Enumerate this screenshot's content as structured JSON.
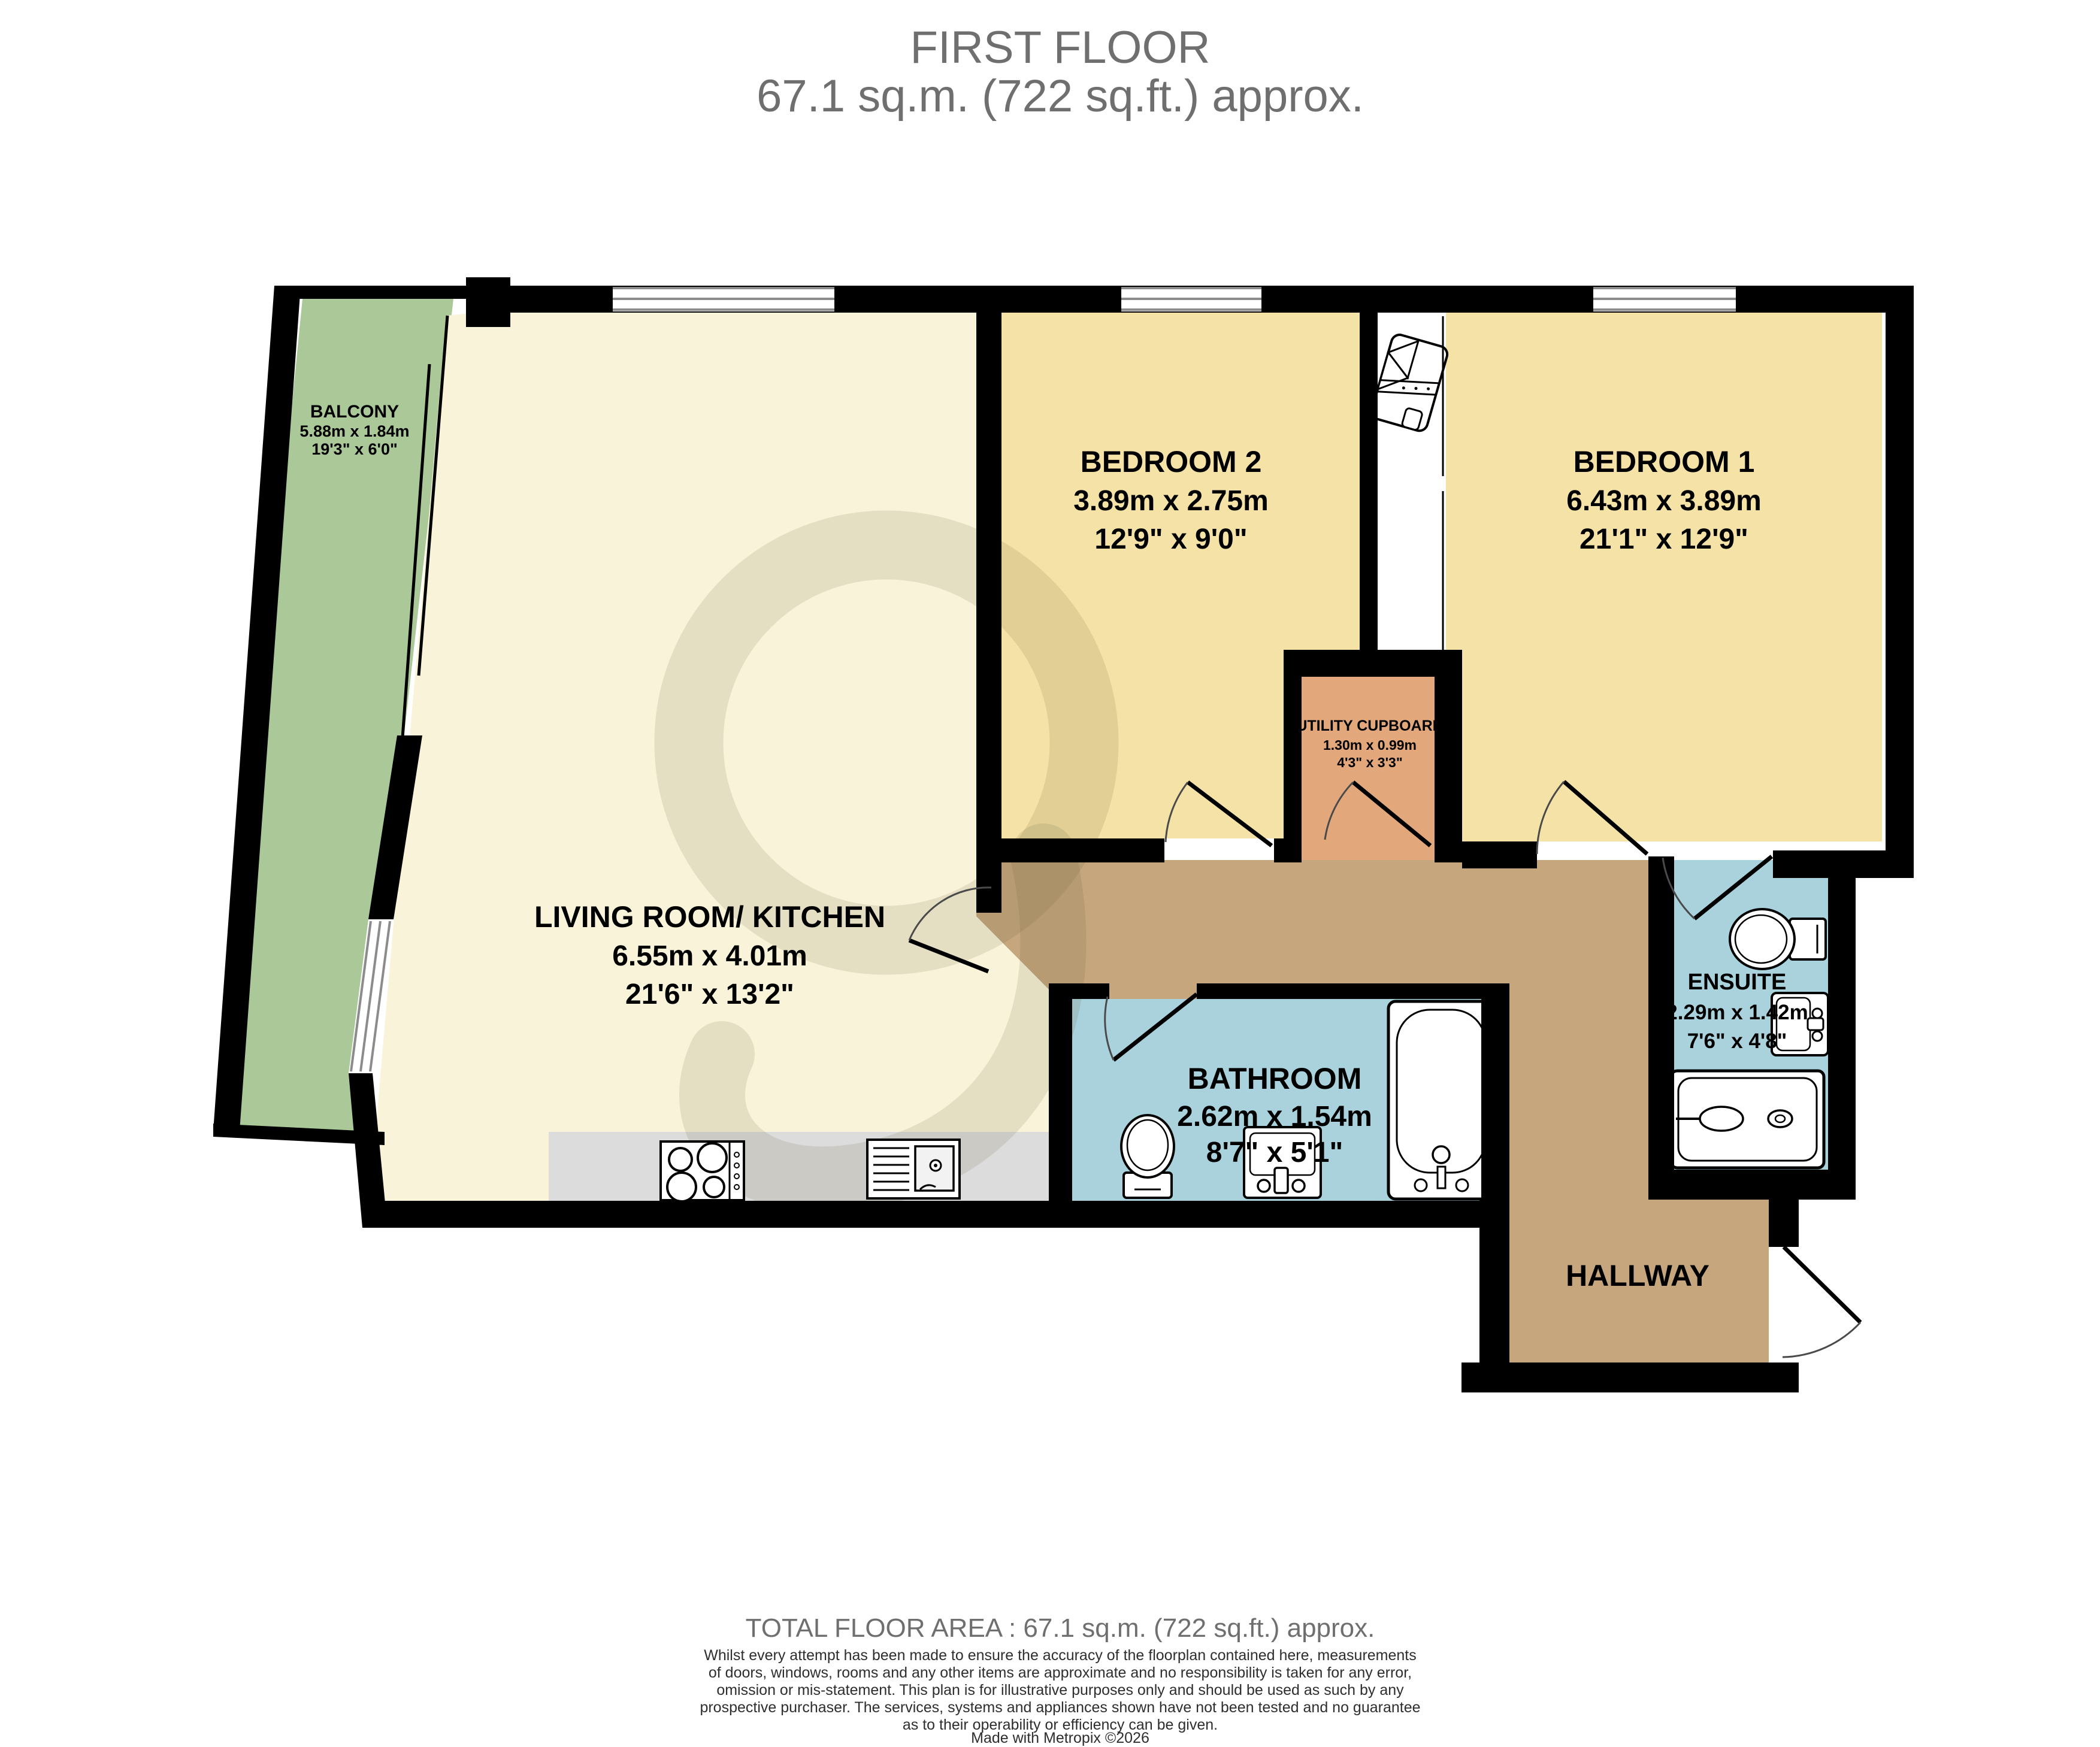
{
  "title": {
    "line1": "FIRST FLOOR",
    "line2": "67.1 sq.m. (722 sq.ft.) approx."
  },
  "rooms": {
    "balcony": {
      "name": "BALCONY",
      "metric": "5.88m  x 1.84m",
      "imperial": "19'3\"  x 6'0\""
    },
    "living_room_kitchen": {
      "name": "LIVING ROOM/ KITCHEN",
      "metric": "6.55m  x 4.01m",
      "imperial": "21'6\"  x 13'2\""
    },
    "bedroom2": {
      "name": "BEDROOM 2",
      "metric": "3.89m  x 2.75m",
      "imperial": "12'9\"  x 9'0\""
    },
    "bedroom1": {
      "name": "BEDROOM 1",
      "metric": "6.43m  x 3.89m",
      "imperial": "21'1\"  x 12'9\""
    },
    "utility_cupboard": {
      "name": "UTILITY CUPBOARD",
      "metric": "1.30m  x 0.99m",
      "imperial": "4'3\"  x 3'3\""
    },
    "bathroom": {
      "name": "BATHROOM",
      "metric": "2.62m  x 1.54m",
      "imperial": "8'7\"  x 5'1\""
    },
    "ensuite": {
      "name": "ENSUITE",
      "metric": "2.29m  x 1.42m",
      "imperial": "7'6\"  x 4'8\""
    },
    "hallway": {
      "name": "HALLWAY"
    }
  },
  "footer": {
    "total_area": "TOTAL FLOOR AREA : 67.1 sq.m. (722 sq.ft.) approx.",
    "disclaimer_lines": [
      "Whilst every attempt has been made to ensure the accuracy of the floorplan contained here, measurements",
      "of doors, windows, rooms and any other items are approximate and no responsibility is taken for any error,",
      "omission or mis-statement. This plan is for illustrative purposes only and should be used as such by any",
      "prospective purchaser. The services, systems and appliances shown have not been tested and no guarantee",
      "as to their operability or efficiency can be given."
    ],
    "credit": "Made with Metropix ©2026"
  },
  "colors": {
    "wall": "#000000",
    "living": "#f8f3d9",
    "bedroom": "#f5e2a6",
    "balcony": "#abc898",
    "utility": "#e2a87b",
    "wet_room": "#a9d2dc",
    "hallway": "#c5a67d",
    "counter": "#dcdcdc",
    "window": "#ffffff",
    "title": "#6f6f6f",
    "disclaimer": "#2e2e2e"
  },
  "icons": {
    "window": "double-glazed white bar with gray lines",
    "door": "quarter-circle swing arc with leaf",
    "toilet": "toilet top view",
    "sink": "wash basin top view",
    "bathtub": "bathtub top view",
    "shower_bath": "shower bath tray top view",
    "hob": "four ring hob",
    "kitchen_sink": "sink with drainer",
    "boiler": "hot water cylinder in cupboard",
    "watermark": "metropix logo swirl"
  }
}
